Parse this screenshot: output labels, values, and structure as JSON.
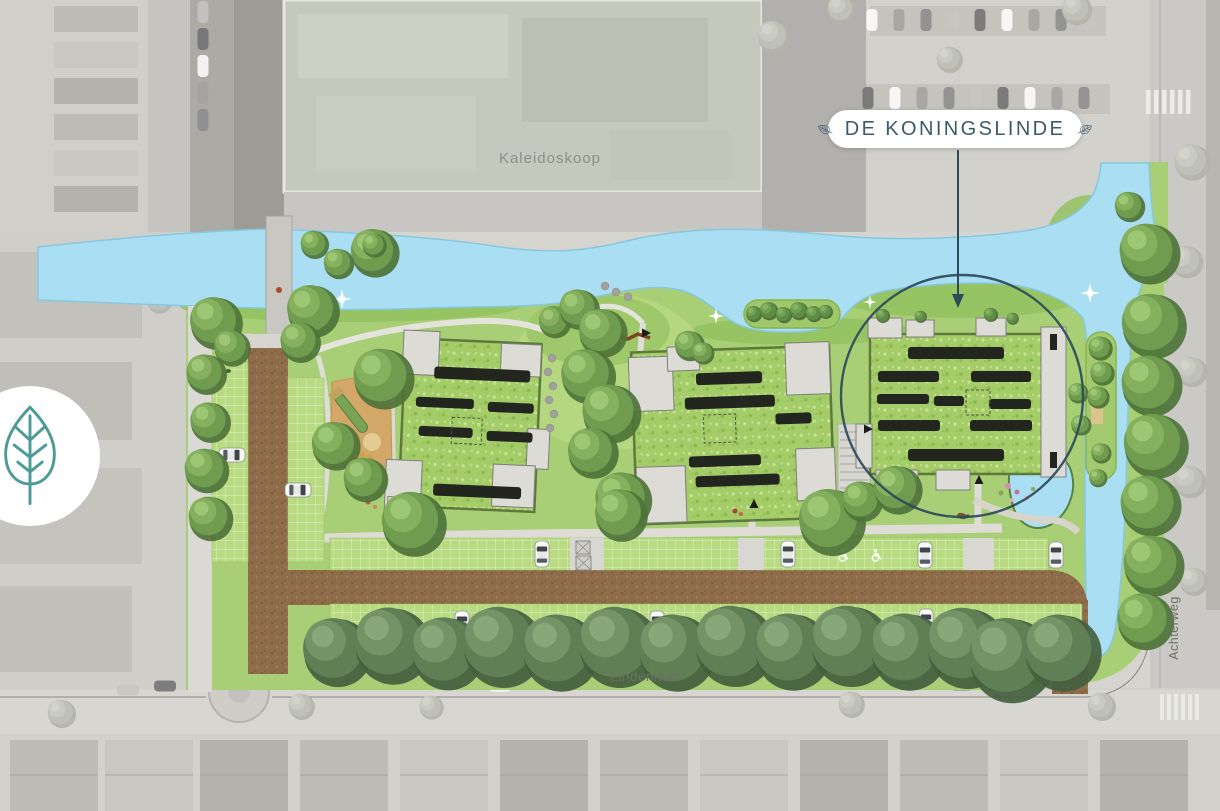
{
  "map": {
    "project_label": "DE KONINGSLINDE",
    "labels": {
      "kaleidoskoop": "Kaleidoskoop",
      "lindenlaan": "Lindenlaan",
      "achterweg": "Achterweg"
    },
    "icons": {
      "badge": "linden-leaf-icon",
      "pill_left": "linden-leaf-icon",
      "pill_right": "linden-leaf-icon"
    },
    "annotation": {
      "type": "circle-with-arrow",
      "label": "DE KONINGSLINDE"
    },
    "colors": {
      "water": "#aadef2",
      "site_green": "#a9cf76",
      "roof_green": "#a4cc68",
      "road_brown": "#8f6d4b",
      "solar_panel": "#22261f",
      "annotation": "#2c4a5a",
      "pill_text": "#3d5a6b",
      "badge_leaf": "#4d9b97",
      "label_gray": "#6e6e68",
      "aerial_washed": "#d6d4cf"
    }
  }
}
